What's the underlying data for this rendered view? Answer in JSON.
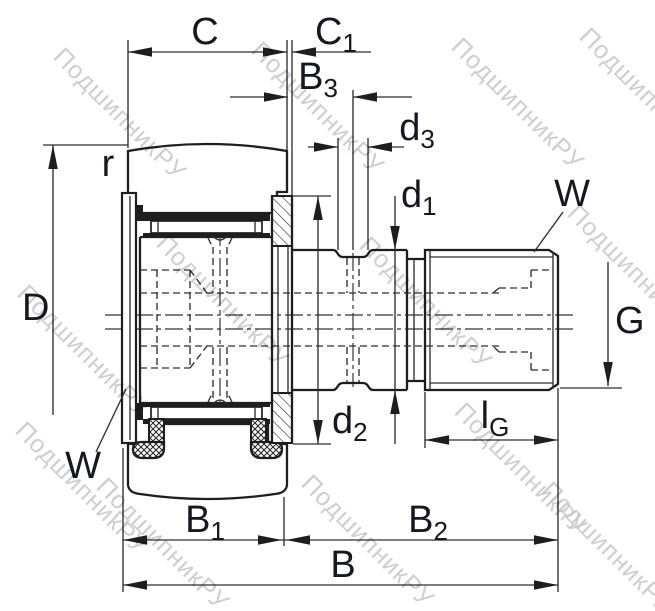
{
  "drawing": {
    "kind": "bearing-cross-section",
    "description": "Stud-type track roller (cam follower) dimensional drawing"
  },
  "labels": {
    "c": "C",
    "c1": {
      "base": "C",
      "sub": "1"
    },
    "b3": {
      "base": "B",
      "sub": "3"
    },
    "d3": {
      "base": "d",
      "sub": "3"
    },
    "d1": {
      "base": "d",
      "sub": "1"
    },
    "d2": {
      "base": "d",
      "sub": "2"
    },
    "lg": {
      "base": "l",
      "sub": "G"
    },
    "b1": {
      "base": "B",
      "sub": "1"
    },
    "b2": {
      "base": "B",
      "sub": "2"
    },
    "b": "B",
    "d": "D",
    "g": "G",
    "r": "r",
    "w_left": "W",
    "w_right": "W"
  },
  "watermark": {
    "text": "ПодшипникРУ"
  },
  "colors": {
    "background": "#ffffff",
    "line": "#1e1e1e",
    "label": "#171720",
    "watermark": "#c6c6c6"
  }
}
